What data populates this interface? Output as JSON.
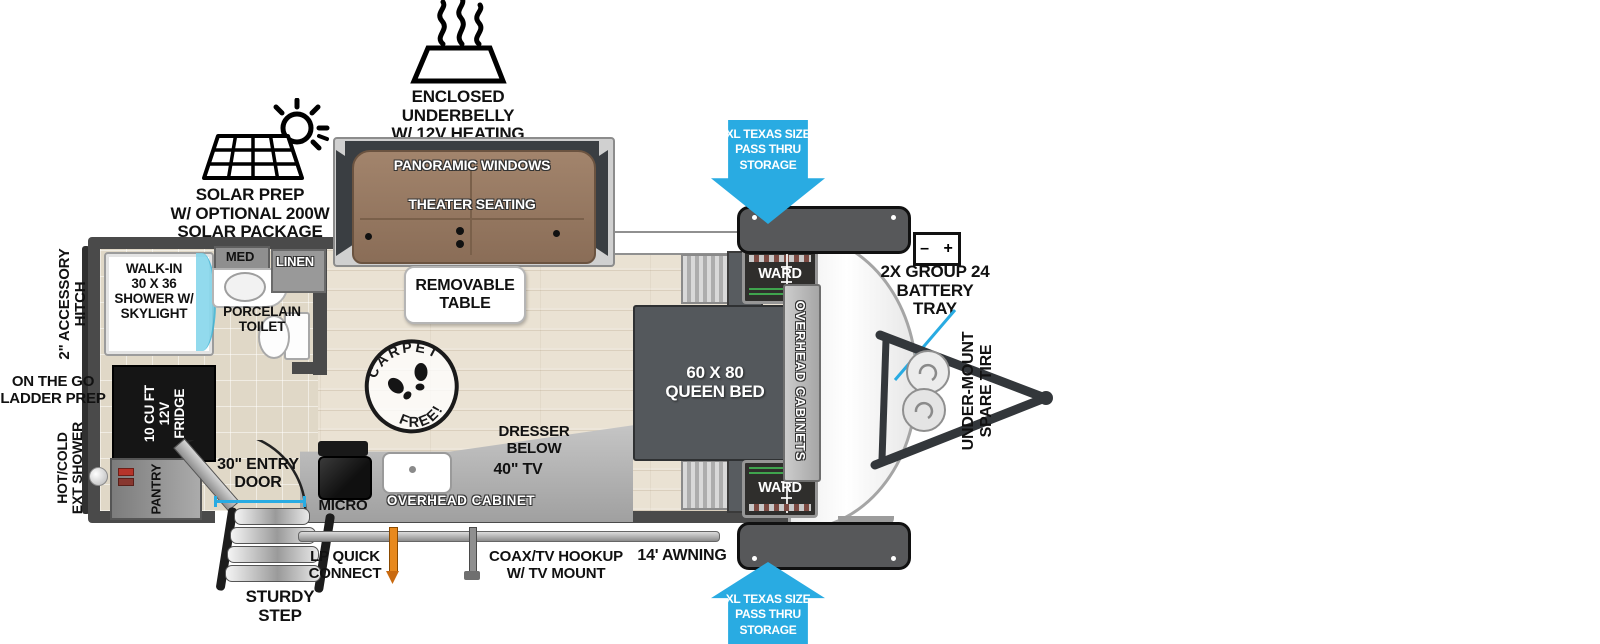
{
  "figure": "travel trailer floorplan",
  "colors": {
    "arrow_blue": "#29abe2",
    "couch_brown": "#9a7c64",
    "wall_gray": "#4a4a4a",
    "bed_gray": "#54585c",
    "lp_orange": "#e8891d",
    "measure_cyan": "#29abe2",
    "ward_green": "#3fa34d",
    "shower_glass_cyan": "#7fd4ea"
  },
  "top_callouts": {
    "underbelly": "ENCLOSED UNDERBELLY\nW/ 12V HEATING PADS",
    "solar": "SOLAR PREP\nW/ OPTIONAL 200W\nSOLAR PACKAGE"
  },
  "front_callouts": {
    "pass_thru_top": "XL TEXAS SIZE\nPASS THRU\nSTORAGE",
    "pass_thru_bottom": "XL TEXAS SIZE\nPASS THRU\nSTORAGE",
    "battery": "2X GROUP 24\nBATTERY\nTRAY",
    "battery_terminals": "–  +",
    "spare_tire": "UNDER-MOUNT\nSPARE TIRE"
  },
  "rear_callouts": {
    "accessory_hitch": "2\" ACCESSORY\nHITCH",
    "ladder_prep": "ON THE GO\nLADDER PREP",
    "ext_shower": "HOT/COLD\nEXT SHOWER"
  },
  "bottom_callouts": {
    "entry_door": "30\" ENTRY\nDOOR",
    "sturdy_step": "STURDY\nSTEP",
    "lp_connect": "LP QUICK\nCONNECT",
    "coax": "COAX/TV HOOKUP\nW/ TV MOUNT",
    "awning": "14' AWNING"
  },
  "living_area": {
    "panoramic_windows": "PANORAMIC WINDOWS",
    "theater_seating": "THEATER SEATING",
    "removable_table": "REMOVABLE\nTABLE",
    "carpet_free": {
      "top": "CARPET",
      "bottom": "FREE!"
    }
  },
  "bedroom": {
    "queen_bed": "60 X 80\nQUEEN BED",
    "overhead_cabinets": "OVERHEAD CABINETS",
    "ward_top": "WARD",
    "ward_bottom": "WARD",
    "dresser": "DRESSER\nBELOW",
    "tv": "40\" TV"
  },
  "bathroom": {
    "shower": "WALK-IN\n30 X 36\nSHOWER W/\nSKYLIGHT",
    "med": "MED",
    "linen": "LINEN",
    "toilet": "PORCELAIN\nTOILET"
  },
  "kitchen": {
    "fridge": "10 CU FT\n12V\nFRIDGE",
    "pantry": "PANTRY",
    "micro": "MICRO",
    "overhead_cabinet": "OVERHEAD CABINET"
  }
}
